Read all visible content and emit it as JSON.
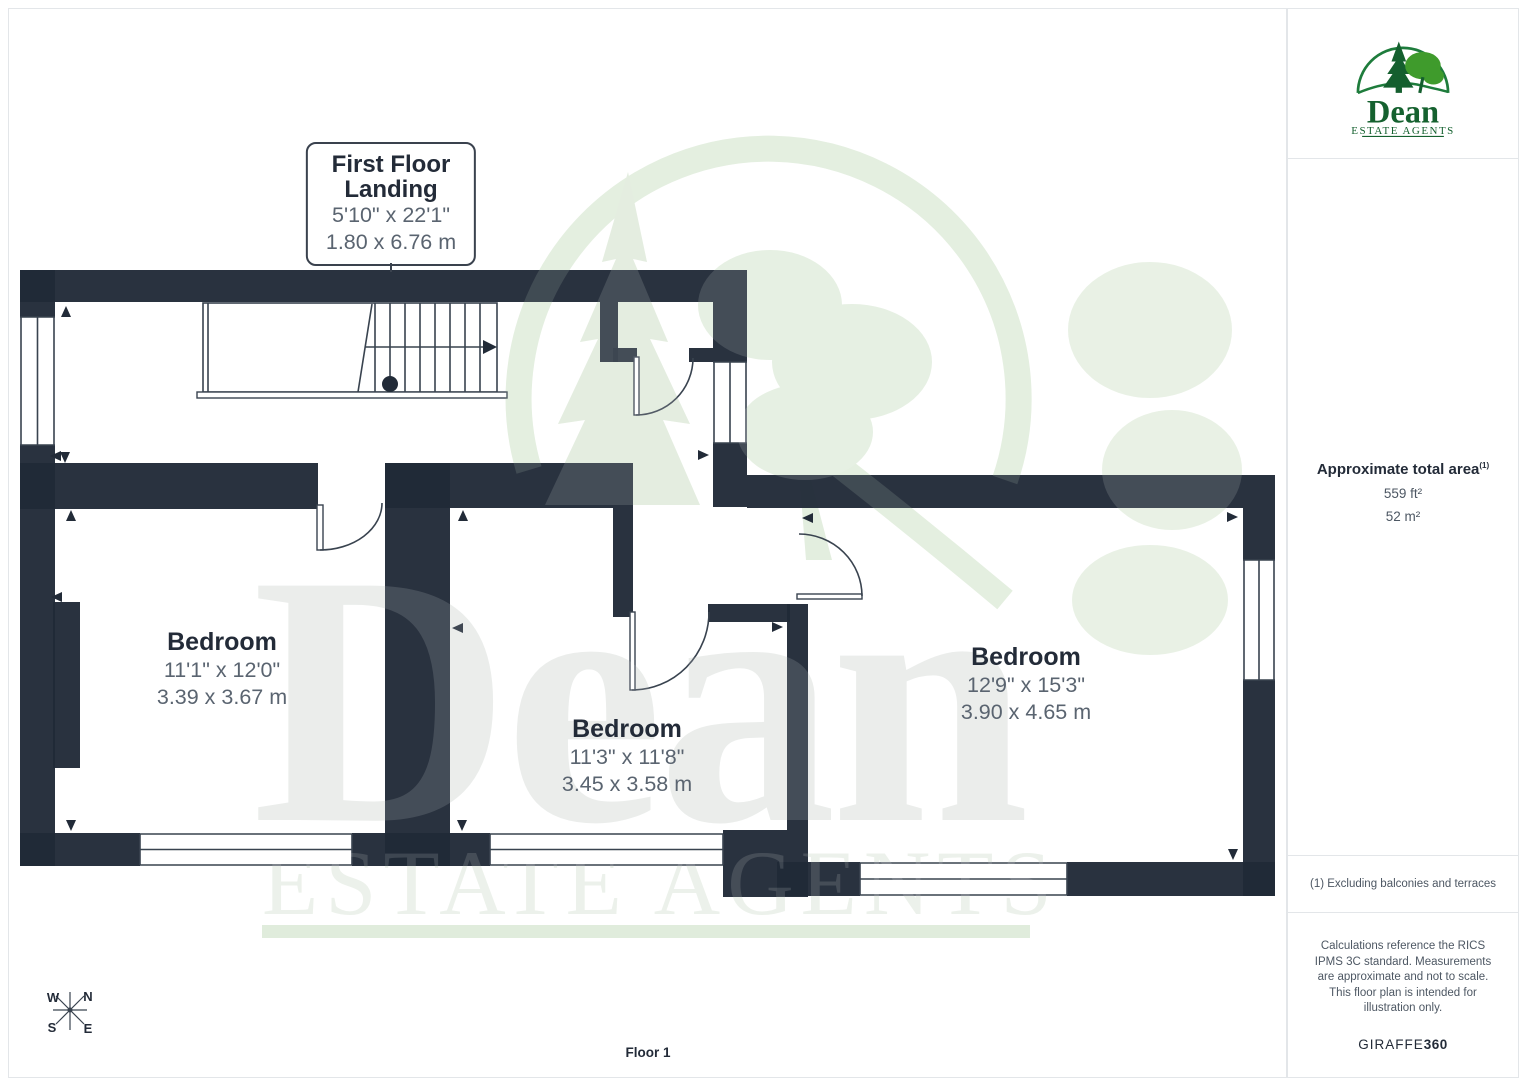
{
  "plan": {
    "landing_label": {
      "title_line1": "First Floor",
      "title_line2": "Landing",
      "imperial": "5'10\" x 22'1\"",
      "metric": "1.80 x 6.76 m"
    },
    "rooms": [
      {
        "name": "Bedroom",
        "imperial": "11'1\" x 12'0\"",
        "metric": "3.39 x 3.67 m"
      },
      {
        "name": "Bedroom",
        "imperial": "11'3\" x 11'8\"",
        "metric": "3.45 x 3.58 m"
      },
      {
        "name": "Bedroom",
        "imperial": "12'9\" x 15'3\"",
        "metric": "3.90 x 4.65 m"
      }
    ],
    "floor_label": "Floor 1",
    "compass": {
      "n": "N",
      "s": "S",
      "e": "E",
      "w": "W"
    }
  },
  "watermark": {
    "word": "Dean",
    "subword": "ESTATE AGENTS"
  },
  "sidebar": {
    "logo": {
      "name": "Dean",
      "tagline": "ESTATE AGENTS"
    },
    "area": {
      "heading": "Approximate total area",
      "footnote_ref": "(1)",
      "sqft": "559 ft²",
      "sqm": "52 m²"
    },
    "footnote": "(1) Excluding balconies and terraces",
    "disclaimer": "Calculations reference the RICS IPMS 3C standard. Measurements are approximate and not to scale. This floor plan is intended for illustration only.",
    "brand": {
      "giraffe": "GIRAFFE",
      "threesixty": "360"
    }
  },
  "colors": {
    "wall": "#222b38",
    "text_dark": "#232b38",
    "text_gray": "#5a6470",
    "logo_green": "#15612f",
    "logo_light_green": "#3f9b2c",
    "watermark_gray": "#e8ebe9",
    "watermark_green": "#e2eedd"
  }
}
